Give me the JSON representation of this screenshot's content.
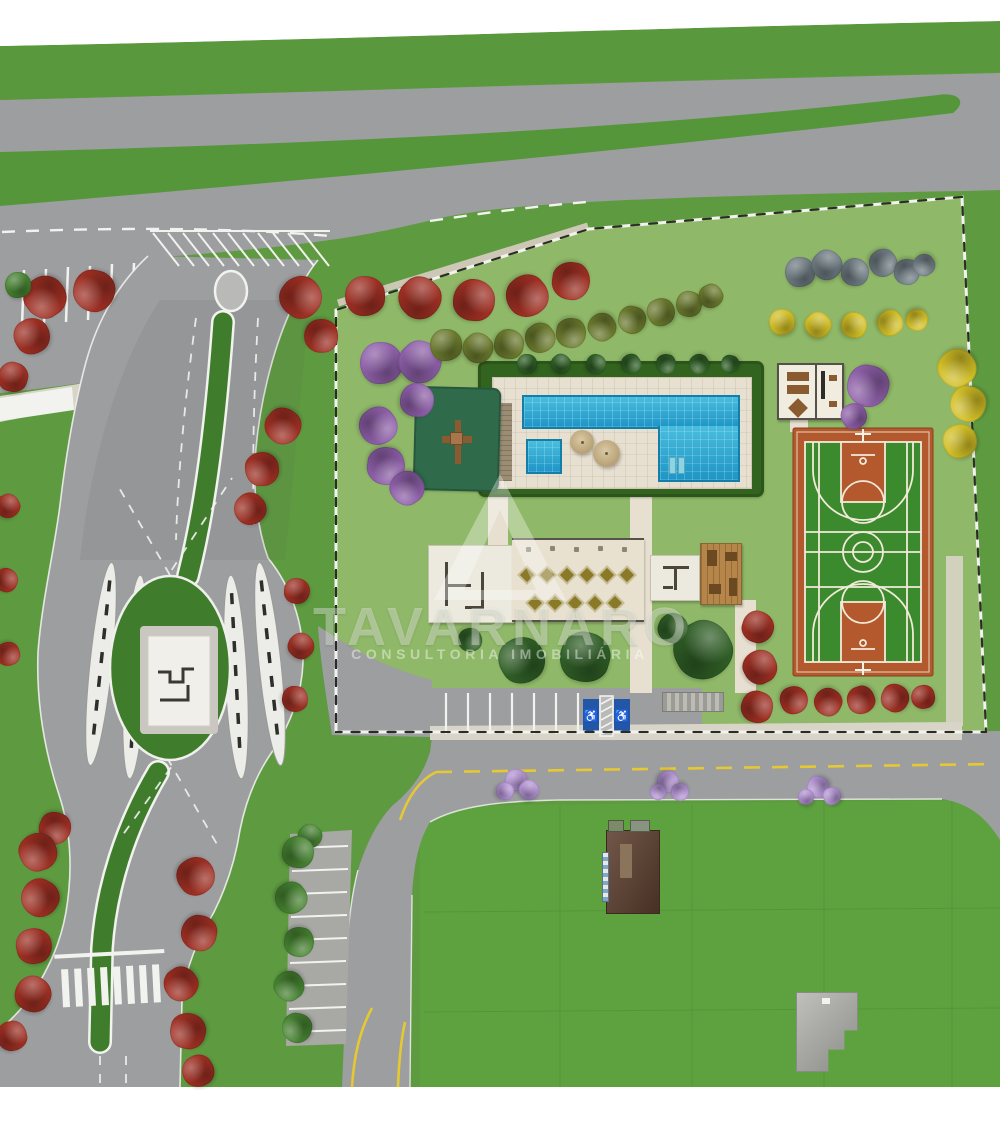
{
  "watermark": {
    "brand": "TAVARNARO",
    "tagline": "CONSULTORIA  IMOBILIÁRIA",
    "logo": "triangle-delta-logo"
  },
  "icons": {
    "wheelchair": "♿"
  },
  "palette": {
    "grass-outer": "#5e9b40",
    "grass-parcel": "#8fb868",
    "grass-lawn": "#5da23f",
    "hedge-band": "#55963a",
    "hedge-dark": "#33641f",
    "road-gray": "#9c9ea0",
    "road-light": "#a8a8a4",
    "sidewalk-light": "#d8d4c8",
    "paver-light": "#e7e0d1",
    "marking-white": "#f2f2ee",
    "marking-yellow": "#e6c832",
    "pool-blue": "#2fa9d2",
    "court-orange": "#b4592e",
    "court-green": "#3c8a2e",
    "court-line": "#f2ead8",
    "island-green": "#3f7d2c",
    "playground-green": "#2f6b4a",
    "equip-brown": "#8a5a30",
    "wall-dark": "#4a463e",
    "deck-wood": "#b5854a",
    "table-olive": "#8a7a28",
    "building-brown": "#5e4030",
    "building-gray": "#aaaaa6",
    "disabled-blue": "#2456a8",
    "tree-red": "#9e2f23",
    "tree-purple": "#8d5fa8",
    "tree-lavender": "#b393d3",
    "tree-yellow": "#d2bf26",
    "tree-olive": "#6b7a2e",
    "tree-gray": "#6e7b82",
    "tree-dark": "#2f5e26",
    "tree-green": "#468231"
  },
  "features": {
    "tree_groups": [
      {
        "name": "red-flowering-tree",
        "color": "tree-red",
        "items": [
          [
            365,
            296,
            20
          ],
          [
            420,
            298,
            21
          ],
          [
            474,
            300,
            21
          ],
          [
            527,
            296,
            21
          ],
          [
            571,
            281,
            19
          ],
          [
            45,
            297,
            21
          ],
          [
            94,
            291,
            21
          ],
          [
            32,
            336,
            18
          ],
          [
            13,
            377,
            15
          ],
          [
            8,
            506,
            12
          ],
          [
            6,
            580,
            12
          ],
          [
            8,
            654,
            12
          ],
          [
            55,
            828,
            16
          ],
          [
            38,
            852,
            19
          ],
          [
            40,
            898,
            19
          ],
          [
            34,
            946,
            18
          ],
          [
            33,
            994,
            18
          ],
          [
            12,
            1036,
            15
          ],
          [
            301,
            297,
            21
          ],
          [
            321,
            336,
            17
          ],
          [
            283,
            426,
            18
          ],
          [
            262,
            469,
            17
          ],
          [
            250,
            509,
            16
          ],
          [
            297,
            591,
            13
          ],
          [
            301,
            646,
            13
          ],
          [
            295,
            699,
            13
          ],
          [
            196,
            876,
            19
          ],
          [
            199,
            933,
            18
          ],
          [
            181,
            984,
            17
          ],
          [
            188,
            1031,
            18
          ],
          [
            198,
            1071,
            16
          ],
          [
            758,
            627,
            16
          ],
          [
            760,
            667,
            17
          ],
          [
            757,
            707,
            16
          ],
          [
            794,
            700,
            14
          ],
          [
            828,
            702,
            14
          ],
          [
            861,
            700,
            14
          ],
          [
            895,
            698,
            14
          ],
          [
            923,
            697,
            12
          ]
        ]
      },
      {
        "name": "purple-tree",
        "color": "tree-purple",
        "items": [
          [
            381,
            363,
            21
          ],
          [
            420,
            362,
            21
          ],
          [
            417,
            400,
            17
          ],
          [
            378,
            426,
            19
          ],
          [
            386,
            466,
            19
          ],
          [
            407,
            488,
            17
          ],
          [
            868,
            386,
            21
          ],
          [
            854,
            416,
            13
          ]
        ]
      },
      {
        "name": "lavender-flowering-tree",
        "color": "tree-lavender",
        "items": [
          [
            516,
            780,
            11
          ],
          [
            529,
            790,
            10
          ],
          [
            505,
            791,
            9
          ],
          [
            668,
            782,
            11
          ],
          [
            680,
            792,
            9
          ],
          [
            658,
            792,
            8
          ],
          [
            818,
            787,
            11
          ],
          [
            832,
            796,
            9
          ],
          [
            806,
            797,
            8
          ]
        ]
      },
      {
        "name": "yellow-flowering-tree",
        "color": "tree-yellow",
        "items": [
          [
            782,
            322,
            13
          ],
          [
            818,
            325,
            13
          ],
          [
            854,
            325,
            13
          ],
          [
            890,
            323,
            13
          ],
          [
            917,
            320,
            11
          ],
          [
            957,
            368,
            19
          ],
          [
            968,
            404,
            18
          ],
          [
            960,
            441,
            17
          ]
        ]
      },
      {
        "name": "olive-shrub",
        "color": "tree-olive",
        "items": [
          [
            446,
            345,
            16
          ],
          [
            478,
            348,
            15
          ],
          [
            509,
            344,
            15
          ],
          [
            540,
            338,
            15
          ],
          [
            571,
            333,
            15
          ],
          [
            602,
            327,
            14
          ],
          [
            632,
            320,
            14
          ],
          [
            661,
            312,
            14
          ],
          [
            689,
            304,
            13
          ],
          [
            711,
            296,
            12
          ]
        ]
      },
      {
        "name": "gray-blue-shrub",
        "color": "tree-gray",
        "items": [
          [
            800,
            272,
            15
          ],
          [
            827,
            265,
            15
          ],
          [
            855,
            272,
            14
          ],
          [
            883,
            263,
            14
          ],
          [
            907,
            272,
            13
          ],
          [
            924,
            265,
            11
          ]
        ]
      },
      {
        "name": "dark-green-tree",
        "color": "tree-dark",
        "items": [
          [
            527,
            364,
            10
          ],
          [
            561,
            364,
            10
          ],
          [
            596,
            364,
            10
          ],
          [
            631,
            364,
            10
          ],
          [
            666,
            364,
            10
          ],
          [
            699,
            364,
            10
          ],
          [
            730,
            364,
            9
          ],
          [
            522,
            660,
            23
          ],
          [
            585,
            657,
            25
          ],
          [
            703,
            650,
            29
          ],
          [
            673,
            628,
            15
          ],
          [
            470,
            640,
            12
          ]
        ]
      },
      {
        "name": "green-tree",
        "color": "tree-green",
        "items": [
          [
            18,
            285,
            13
          ],
          [
            310,
            836,
            12
          ],
          [
            298,
            852,
            16
          ],
          [
            291,
            898,
            16
          ],
          [
            299,
            942,
            15
          ],
          [
            289,
            986,
            15
          ],
          [
            297,
            1028,
            15
          ]
        ]
      }
    ]
  }
}
